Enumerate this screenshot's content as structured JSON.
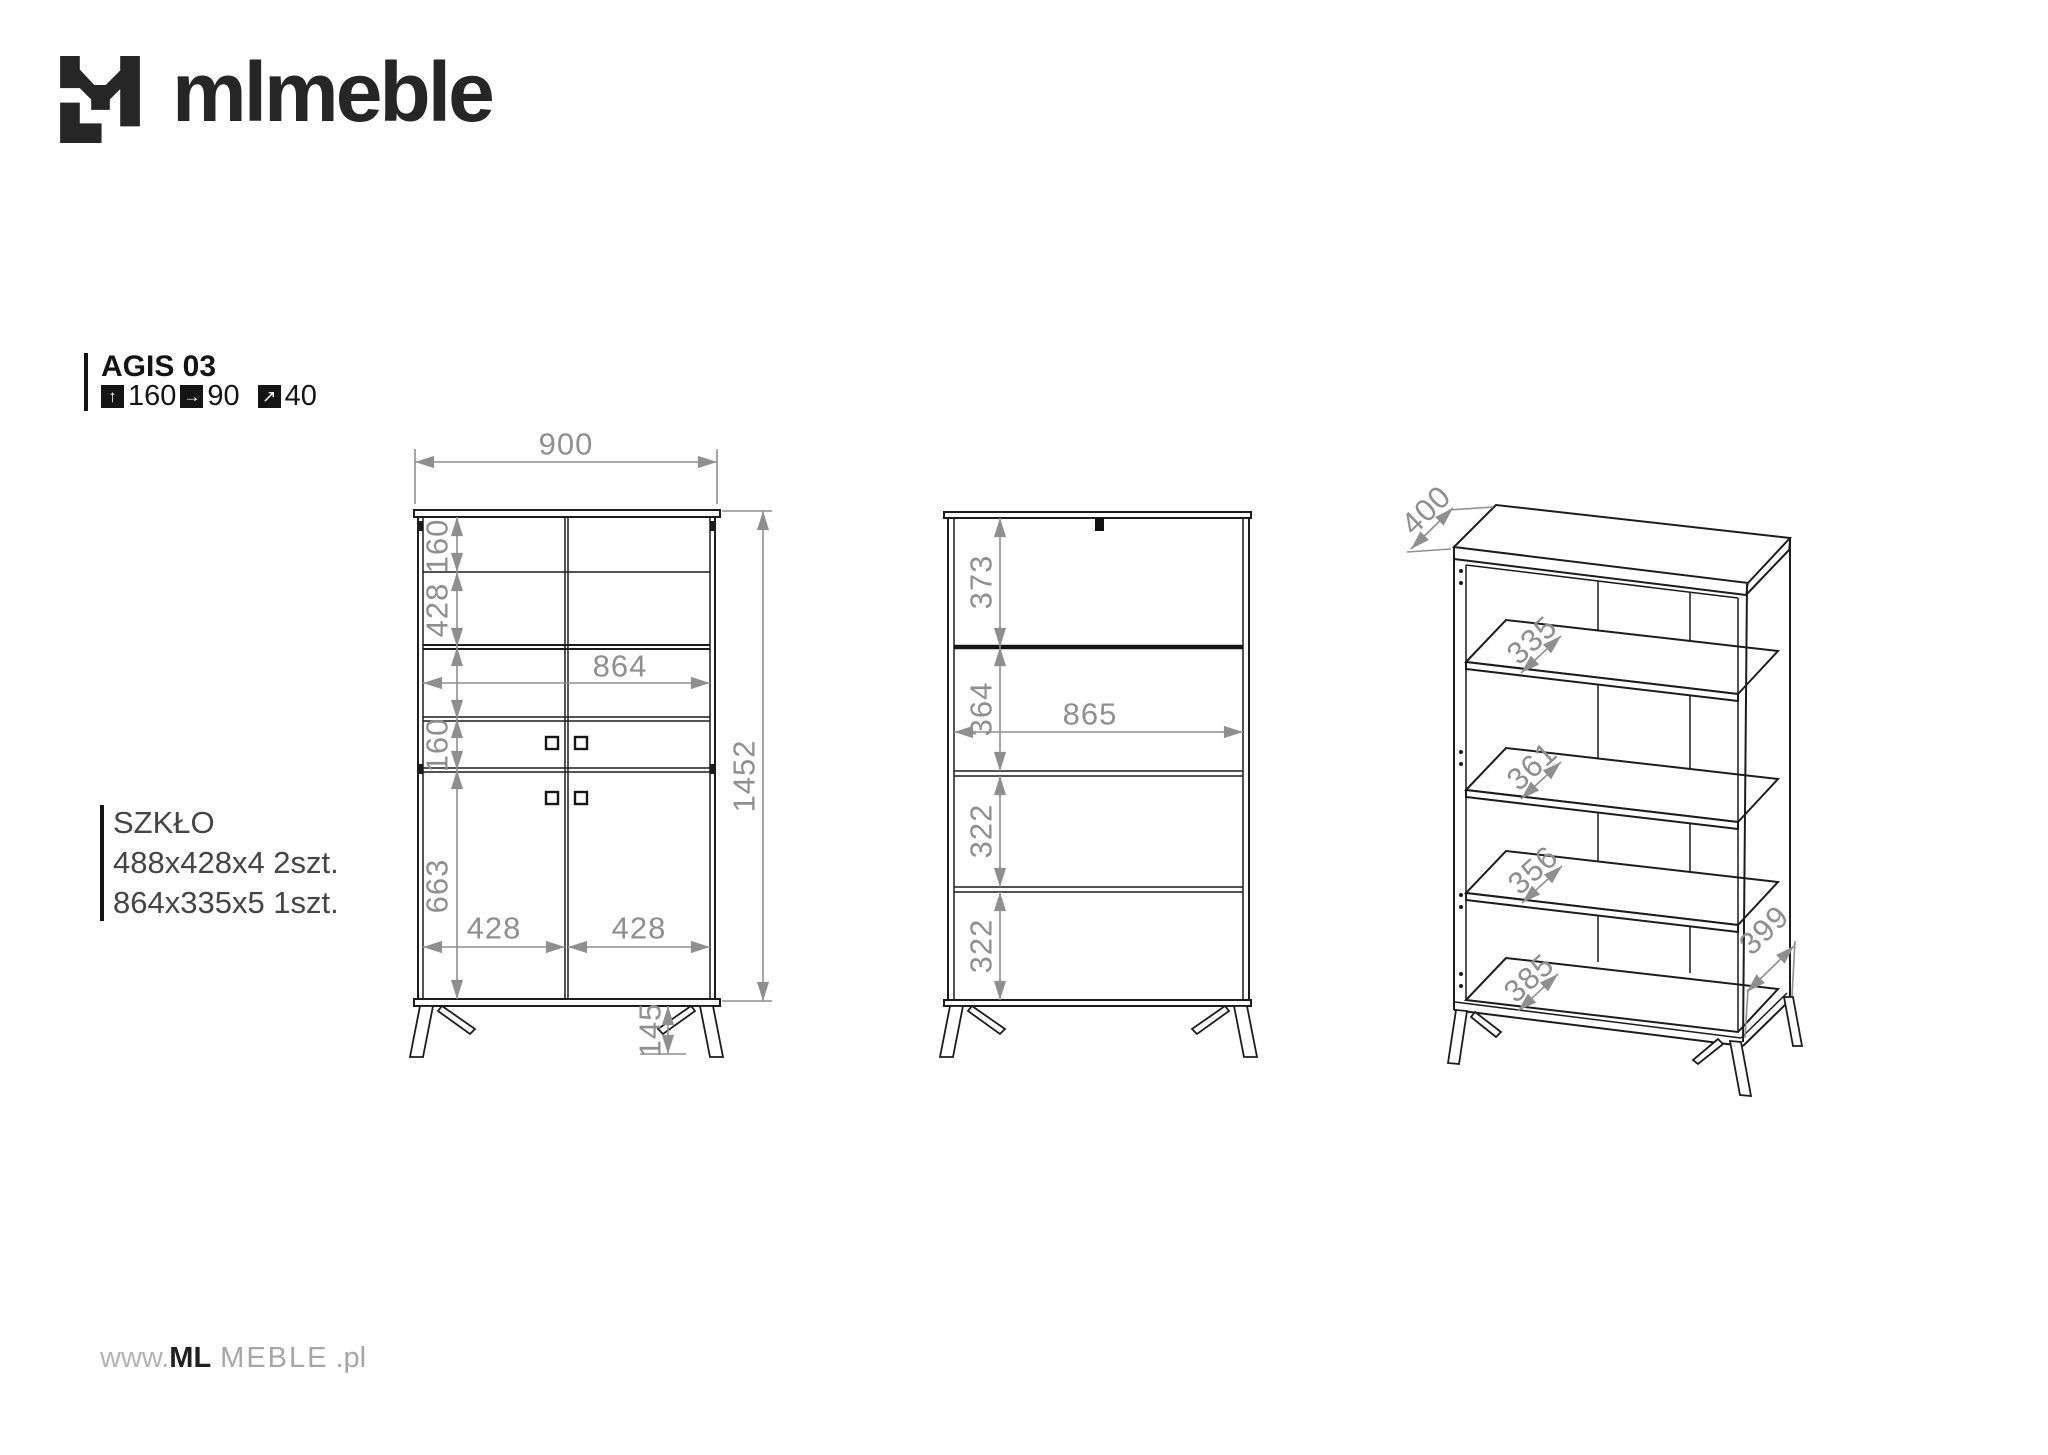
{
  "colors": {
    "line": "#1c1c1c",
    "dim_gray": "#8f8f8f"
  },
  "logo": {
    "text": "mlmeble"
  },
  "product": {
    "name": "AGIS 03",
    "height": "160",
    "width": "90",
    "depth": "40",
    "height_icon": "↑",
    "width_icon": "→",
    "depth_icon": "↗"
  },
  "glass": {
    "title": "SZKŁO",
    "spec1": "488x428x4 2szt.",
    "spec2": "864x335x5 1szt."
  },
  "front": {
    "width": "900",
    "row1_height": "160",
    "row2_height": "428",
    "inner_width": "864",
    "row3_height": "160",
    "door_height": "663",
    "door_left_width": "428",
    "door_right_width": "428",
    "total_height": "1452",
    "leg_height": "145"
  },
  "open": {
    "section1": "373",
    "section2": "364",
    "inner_width": "865",
    "section3": "322",
    "section4": "322"
  },
  "iso": {
    "top_depth": "400",
    "shelf1_depth": "335",
    "shelf2_depth": "361",
    "shelf3_depth": "356",
    "bottom_depth": "385",
    "side_depth": "399"
  },
  "footer": {
    "www": "www.",
    "brand": "ML",
    "name": "MEBLE",
    "tld": ".pl"
  }
}
